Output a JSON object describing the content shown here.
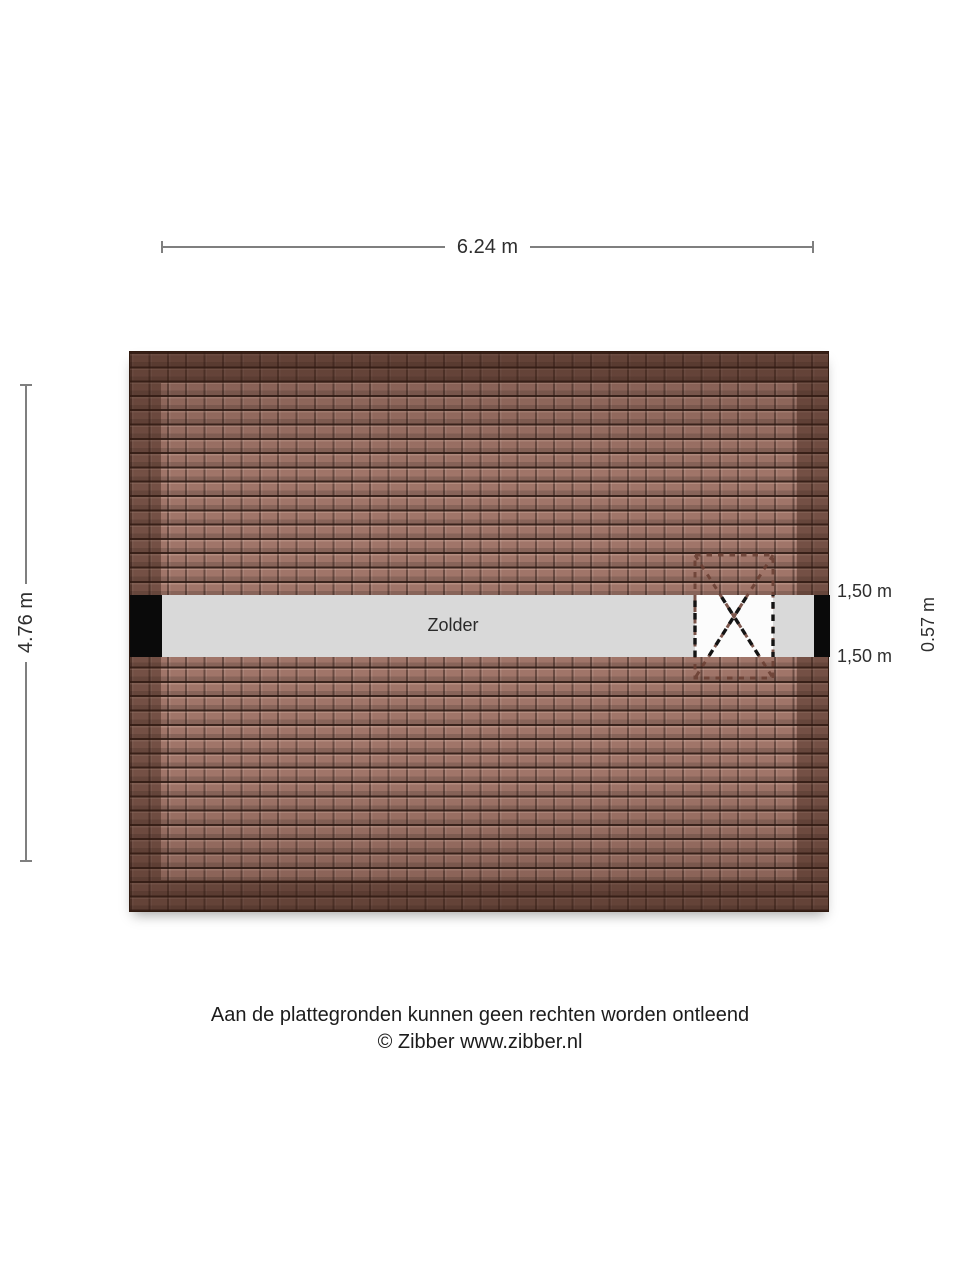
{
  "plan": {
    "room_label": "Zolder",
    "width_dimension": "6.24 m",
    "height_dimension": "4.76 m",
    "skylight": {
      "top_distance_label": "1,50 m",
      "bottom_distance_label": "1,50 m",
      "height_label": "0.57 m"
    },
    "colors": {
      "roof_tile": "#a07569",
      "roof_frame_shadow": "#36201480",
      "floor_strip": "#d9d9d9",
      "wall": "#0a0a0a",
      "dimension_line": "#7f7f7f",
      "skylight_dash_on_roof": "#6b4034",
      "skylight_dash_on_floor": "#141414"
    }
  },
  "footer": {
    "disclaimer": "Aan de plattegronden kunnen geen rechten worden ontleend",
    "copyright": "© Zibber www.zibber.nl"
  }
}
